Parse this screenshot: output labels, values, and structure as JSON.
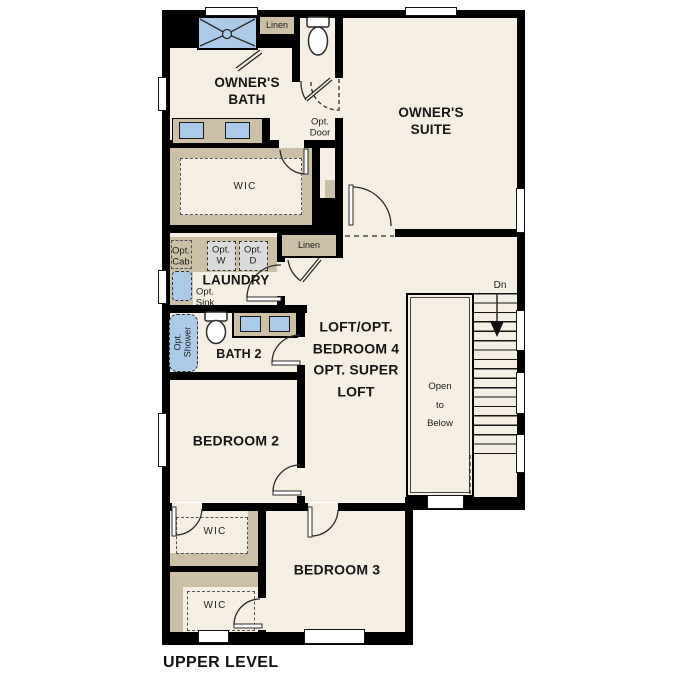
{
  "plan": {
    "level_title": "UPPER LEVEL",
    "rooms": {
      "owners_bath": "OWNER'S\nBATH",
      "owners_suite": "OWNER'S\nSUITE",
      "wic_upper": "WIC",
      "laundry": "LAUNDRY",
      "bath2": "BATH 2",
      "loft": "LOFT/OPT.\nBEDROOM 4\nOPT. SUPER\nLOFT",
      "bedroom2": "BEDROOM 2",
      "bedroom3": "BEDROOM 3",
      "wic_bedroom2": "WIC",
      "wic_bedroom3": "WIC",
      "open_to_below": "Open\nto\nBelow"
    },
    "annotations": {
      "linen_upper": "Linen",
      "linen_hall": "Linen",
      "opt_door": "Opt.\nDoor",
      "opt_cab": "Opt.\nCab",
      "opt_washer": "Opt.\nW",
      "opt_dryer": "Opt.\nD",
      "opt_sink": "Opt.\nSink",
      "opt_shower": "Opt.\nShower",
      "stairs_down": "Dn"
    },
    "colors": {
      "floor": "#f4efe2",
      "wall": "#000000",
      "cabinetry": "#cbbfa5",
      "fixture_blue": "#abcae8",
      "appliance_gray": "#dbdbdb"
    }
  }
}
